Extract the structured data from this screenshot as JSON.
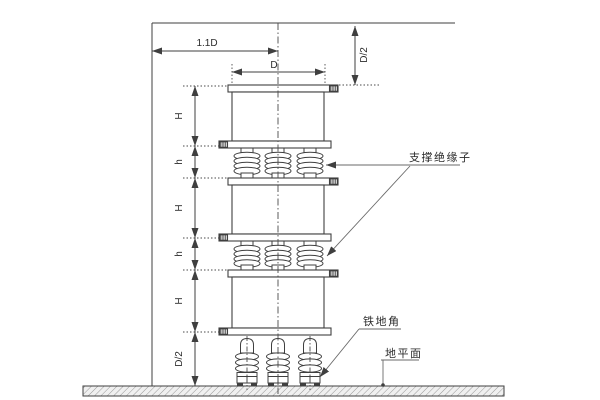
{
  "drawing": {
    "dimensions": {
      "top_width": "1.1D",
      "unit_width": "D",
      "top_clearance": "D/2",
      "chain": [
        {
          "label": "H"
        },
        {
          "label": "h"
        },
        {
          "label": "H"
        },
        {
          "label": "h"
        },
        {
          "label": "H"
        },
        {
          "label": "D/2"
        }
      ]
    },
    "annotations": {
      "support_insulator": "支撑绝缘子",
      "iron_foot": "铁地角",
      "ground_plane": "地平面"
    },
    "colors": {
      "line": "#3f3f3f",
      "ground_hatch": "#979797",
      "ground_fill": "#f0f0f0",
      "background": "#ffffff"
    }
  }
}
